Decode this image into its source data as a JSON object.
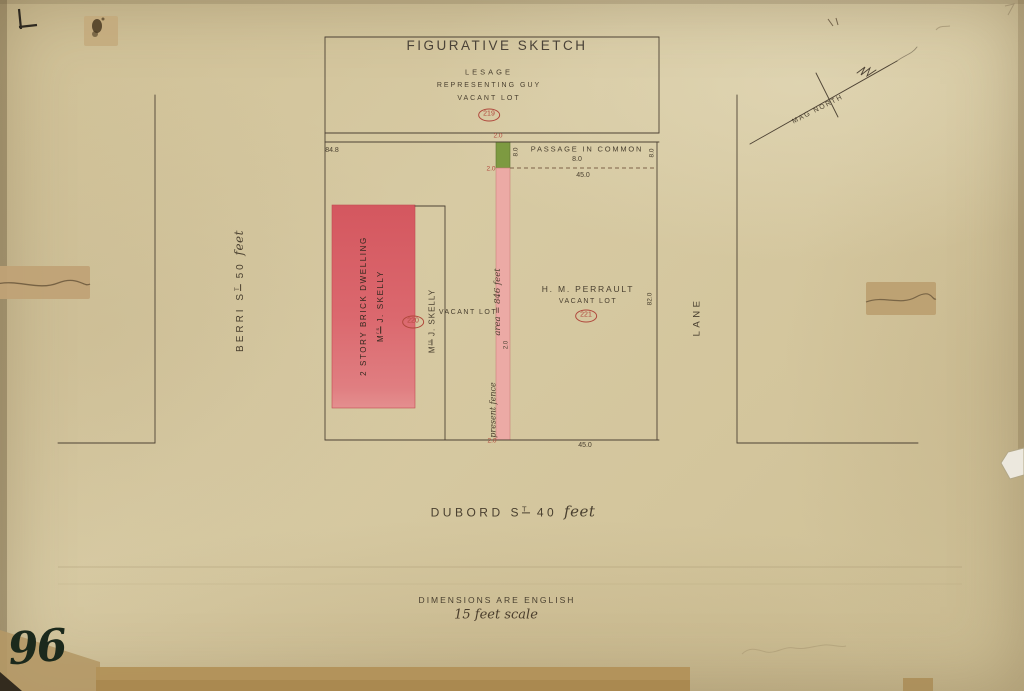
{
  "title": "FIGURATIVE SKETCH",
  "north": {
    "label": "MAG NORTH"
  },
  "lesage": {
    "name": "LESAGE",
    "line2": "REPRESENTING GUY",
    "line3": "VACANT LOT",
    "lot_number": "219"
  },
  "passage": {
    "label": "PASSAGE IN COMMON",
    "width": "8.0",
    "west_width": "8.0",
    "east_width": "8.0",
    "length_top": "45.0",
    "length_bottom": "45.0",
    "north_dim": "84.8",
    "strip_width_top": "2.0",
    "strip_width_junction": "2.0",
    "strip_width_mid": "2.0",
    "strip_width_bottom": "2.0",
    "area_note": "area = 846 feet",
    "fence_note": "present fence"
  },
  "skelly": {
    "building_line1": "2 STORY BRICK DWELLING",
    "building_owner_pre": "M",
    "building_owner_sup": "rs",
    "building_owner_rest": " J. SKELLY",
    "lot_owner_pre": "M",
    "lot_owner_sup": "rs",
    "lot_owner_rest": " J. SKELLY",
    "lot_label": "VACANT LOT",
    "lot_number": "220"
  },
  "perrault": {
    "owner": "H. M. PERRAULT",
    "lot_label": "VACANT LOT",
    "lot_number": "221",
    "east_dim": "82.0"
  },
  "streets": {
    "berri_pre": "BERRI S",
    "berri_sup": "T",
    "berri_num": " 50 ",
    "berri_unit": "feet",
    "dubord_pre": "DUBORD S",
    "dubord_sup": "T",
    "dubord_num": " 40 ",
    "dubord_unit": "feet",
    "lane": "LANE"
  },
  "notes": {
    "line1": "DIMENSIONS ARE ENGLISH",
    "line2": "15 feet scale"
  },
  "page_number": "96",
  "colors": {
    "ink": "#4a4030",
    "red_ink": "#b0483c",
    "building_red": "#d9636b",
    "strip_pink": "#ecaaa5",
    "strip_green": "#7d9a41",
    "paper": "#d3c59c",
    "tape": "#c0a276"
  }
}
